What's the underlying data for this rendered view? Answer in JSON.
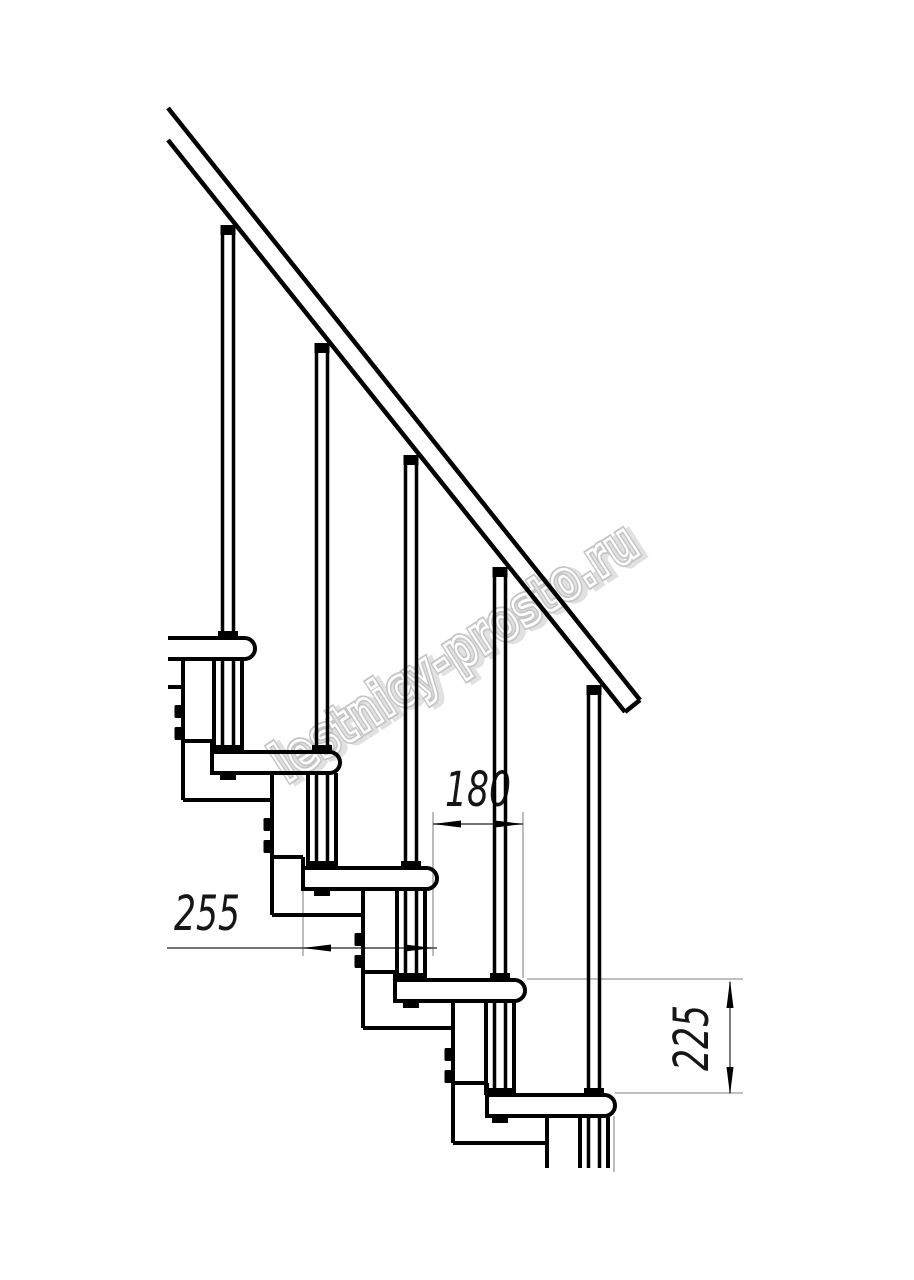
{
  "drawing": {
    "dimensions": {
      "going_mm": "180",
      "run_mm": "255",
      "rise_mm": "225"
    },
    "watermark": "lestnicy-prosto.ru",
    "colors": {
      "structure_line": "#000000",
      "dimension_line": "#444444",
      "extension_line": "#999999",
      "watermark_outline": "#c2c2c2",
      "background": "#ffffff"
    }
  }
}
